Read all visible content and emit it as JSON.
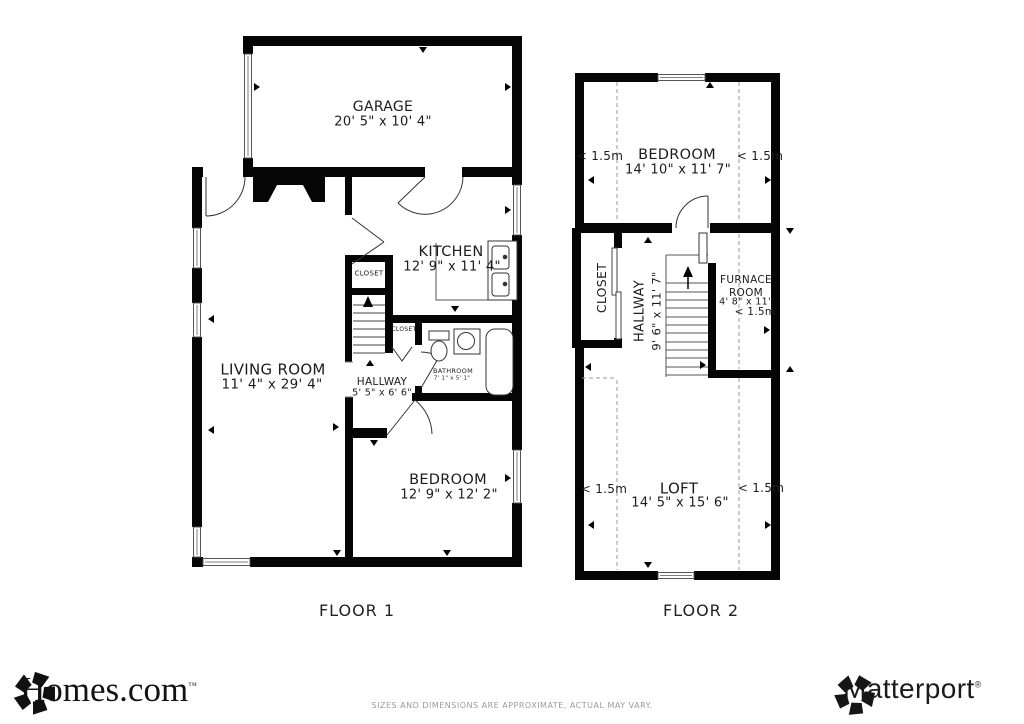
{
  "floor1": {
    "label": "FLOOR 1",
    "rooms": {
      "garage": {
        "name": "GARAGE",
        "dims": "20' 5\" x 10' 4\""
      },
      "kitchen": {
        "name": "KITCHEN",
        "dims": "12' 9\" x 11' 4\""
      },
      "living_room": {
        "name": "LIVING ROOM",
        "dims": "11' 4\" x 29' 4\""
      },
      "hallway": {
        "name": "HALLWAY",
        "dims": "5' 5\" x 6' 6\""
      },
      "bathroom": {
        "name": "BATHROOM",
        "dims": "7' 1\" x 5' 1\""
      },
      "bedroom": {
        "name": "BEDROOM",
        "dims": "12' 9\" x 12' 2\""
      },
      "closet_upper": {
        "name": "CLOSET"
      },
      "closet_lower": {
        "name": "CLOSET"
      }
    }
  },
  "floor2": {
    "label": "FLOOR 2",
    "height_marker": "< 1.5m",
    "rooms": {
      "bedroom": {
        "name": "BEDROOM",
        "dims": "14' 10\" x 11' 7\""
      },
      "closet": {
        "name": "CLOSET"
      },
      "hallway": {
        "name": "HALLWAY",
        "dims": "9' 6\" x 11' 7\""
      },
      "furnace_room": {
        "name": "FURNACE ROOM",
        "dims": "4' 8\" x 11'"
      },
      "loft": {
        "name": "LOFT",
        "dims": "14' 5\" x 15' 6\""
      }
    }
  },
  "footer": {
    "homes_brand": "Homes.com",
    "homes_trademark": "™",
    "matterport_brand": "Matterport",
    "matterport_trademark": "®",
    "disclaimer": "SIZES AND DIMENSIONS ARE APPROXIMATE, ACTUAL MAY VARY."
  }
}
